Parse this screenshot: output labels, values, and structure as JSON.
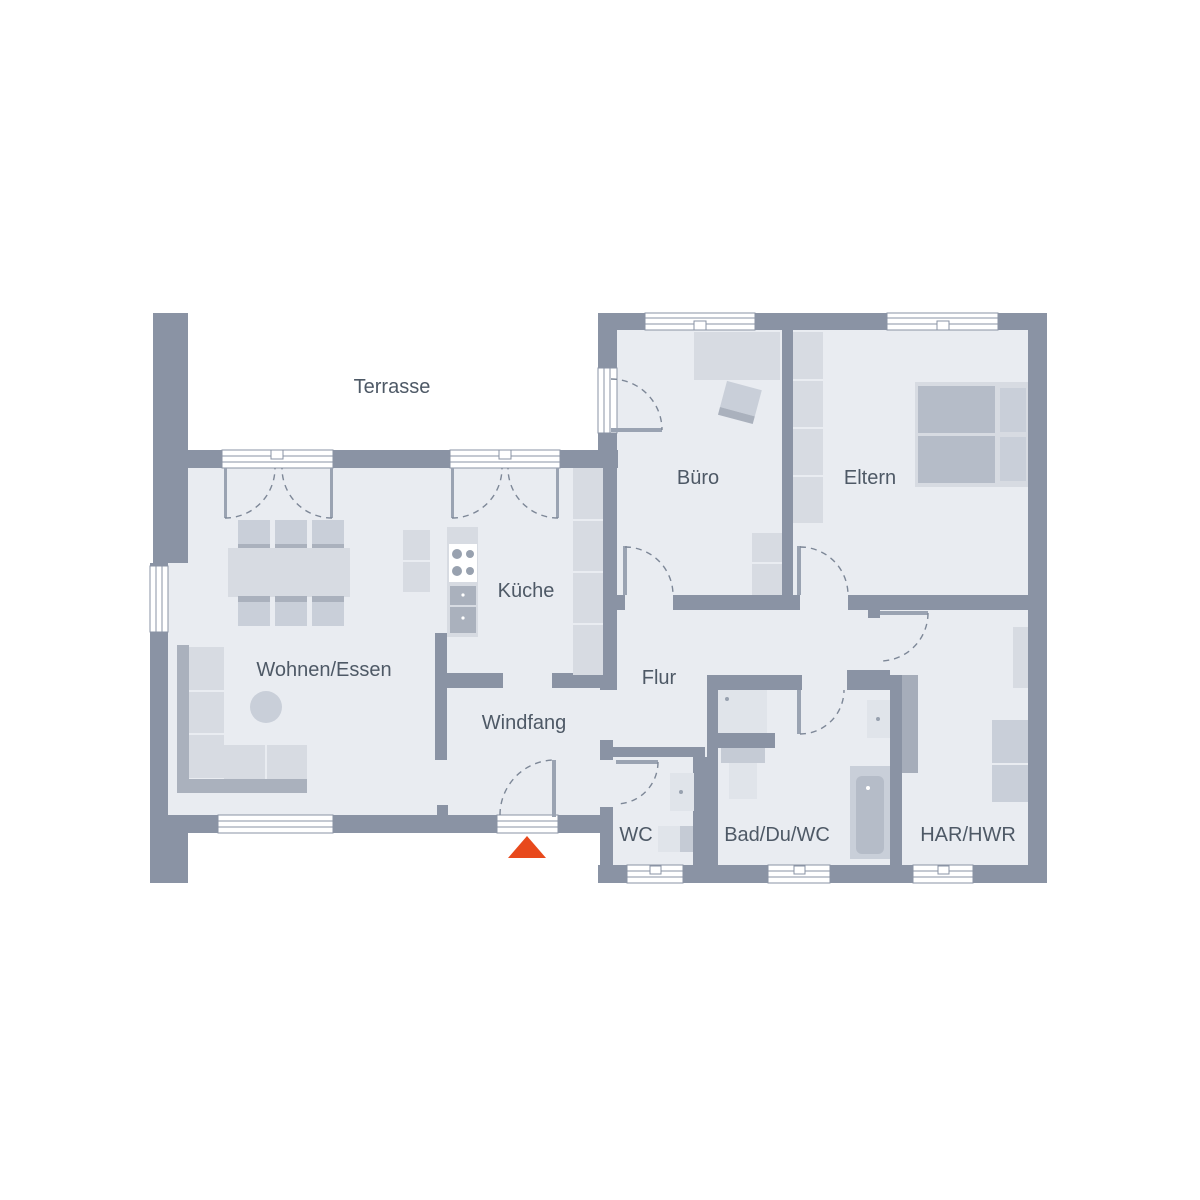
{
  "rooms": [
    {
      "label": "Terrasse"
    },
    {
      "label": "Büro"
    },
    {
      "label": "Eltern"
    },
    {
      "label": "Küche"
    },
    {
      "label": "Wohnen/Essen"
    },
    {
      "label": "Flur"
    },
    {
      "label": "Windfang"
    },
    {
      "label": "WC"
    },
    {
      "label": "Bad/Du/WC"
    },
    {
      "label": "HAR/HWR"
    }
  ],
  "markers": {
    "entrance_marker": "red-triangle"
  },
  "colors": {
    "wall": "#8a93a4",
    "wall2": "#a6adba",
    "floor": "#e9ecf1",
    "accent": "#e8491c",
    "text": "#4e5966",
    "furna": "#d7dbe2",
    "furnb": "#c9cfd9",
    "furnc": "#aab1bd",
    "mattress": "#b5bcc8",
    "fixture": "#e0e4ea",
    "tank": "#c5cbd5",
    "leaf": "#9aa3b2",
    "arc": "#7d8797",
    "dotc": "#98a1af"
  }
}
